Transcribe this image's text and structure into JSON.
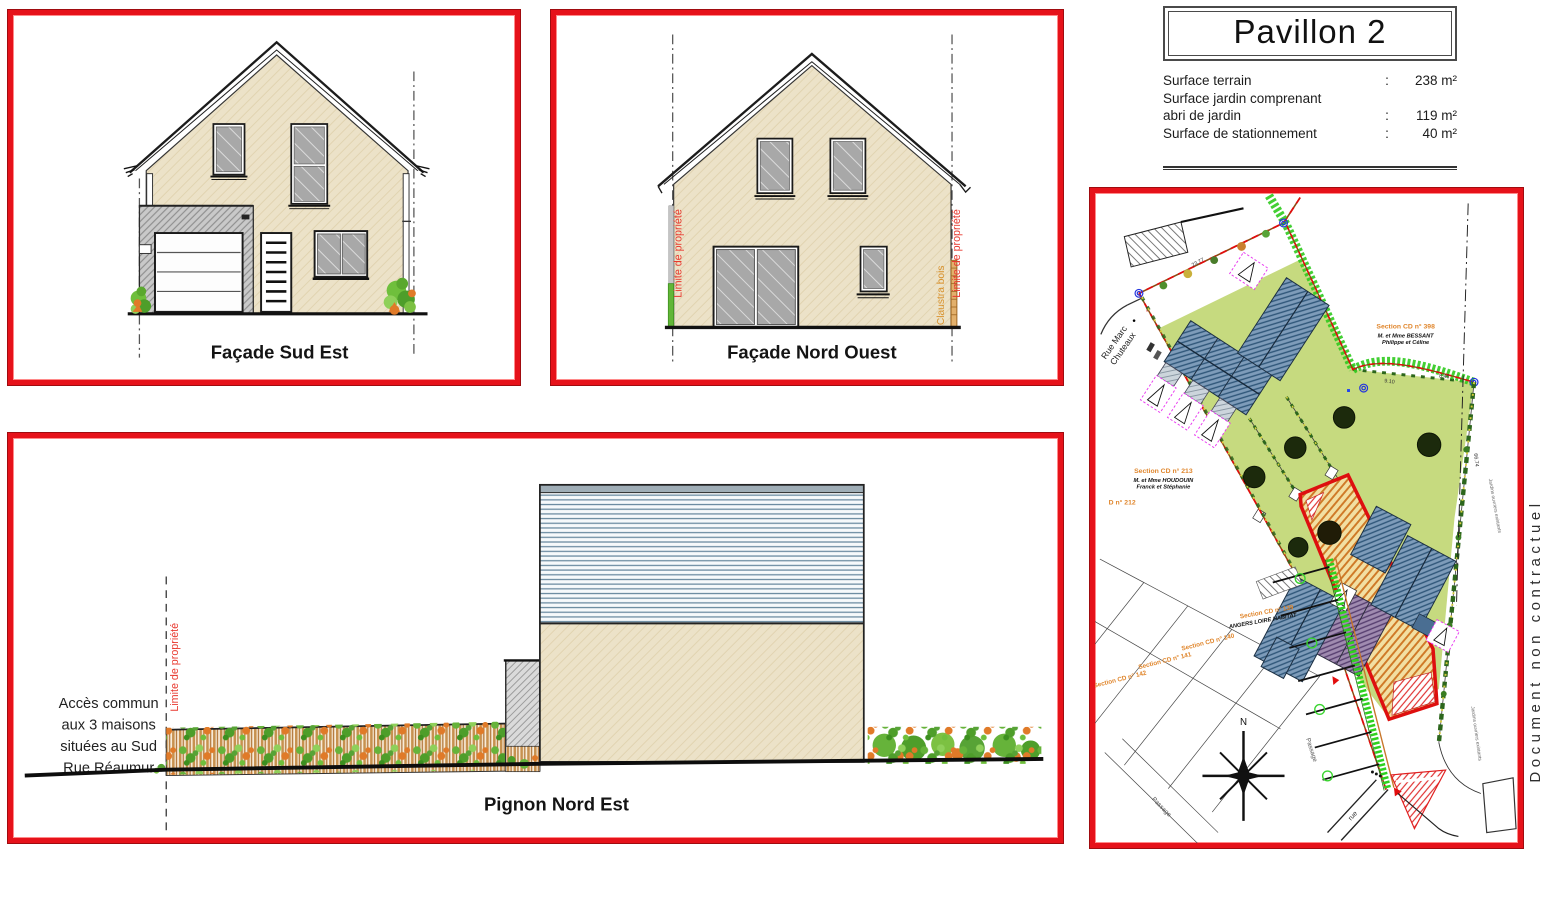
{
  "title_block": {
    "title": "Pavillon 2",
    "rows": [
      {
        "label": "Surface terrain",
        "sep": ":",
        "value": "238 m²"
      },
      {
        "label": "Surface jardin comprenant",
        "sep": "",
        "value": ""
      },
      {
        "label": "abri de jardin",
        "sep": ":",
        "value": "119 m²"
      },
      {
        "label": "Surface de stationnement",
        "sep": ":",
        "value": "40 m²"
      }
    ]
  },
  "watermark": "Document non contractuel",
  "facade_sud_est": {
    "caption": "Façade Sud Est"
  },
  "facade_nord_ouest": {
    "caption": "Façade Nord Ouest",
    "limite_left": "Limite de propriété",
    "limite_right": "Limite de propriété",
    "claustra": "Claustra bois"
  },
  "pignon_nord_est": {
    "caption": "Pignon Nord Est",
    "limite": "Limite de propriété",
    "access_lines": [
      "Accès commun",
      "aux  3 maisons",
      "situées au Sud",
      "Rue Réaumur"
    ]
  },
  "site_plan": {
    "street1": "Rue Marc",
    "street2": "Chuteaux",
    "north": "N",
    "labels": {
      "cd398": "Section CD n° 398",
      "cd398_owner1": "M. et Mme BESSANT",
      "cd398_owner2": "Philippe et Céline",
      "cd213": "Section CD n° 213",
      "cd213_owner1": "M. et Mme HOUDOUIN",
      "cd213_owner2": "Franck et Stéphanie",
      "d212": "D n° 212",
      "cd139": "Section CD n° 139",
      "cd139_owner": "ANGERS LOIRE HABITAT",
      "cd140": "Section CD n° 140",
      "cd141": "Section CD n° 141",
      "cd142": "Section CD n° 142"
    },
    "dimensions": {
      "d1": "23.77",
      "d2": "8.46",
      "d3": "9.10",
      "d4": "66.74"
    },
    "passage": "Passage",
    "rue": "rue",
    "jardins": "Jardins ouvriers existants"
  },
  "colors": {
    "panel_border": "#e6121a",
    "wall_beige": "#ece2c8",
    "roof_gray": "#c9c9c9",
    "glass_gray": "#a8a8a8",
    "bush_green": "#6fbf3c",
    "bush_orange": "#e07a28",
    "garden_green": "#c6da7f",
    "roof_blue": "#7e9cba",
    "plot_red": "#de0f0f",
    "hedge_dark_green": "#2c661c",
    "hedge_bright_green": "#2fca1e",
    "limite_red": "#e8392f",
    "claustra_orange": "#d8912c",
    "orange_label": "#e0862c",
    "siding_blue": "#6a8aa0"
  }
}
